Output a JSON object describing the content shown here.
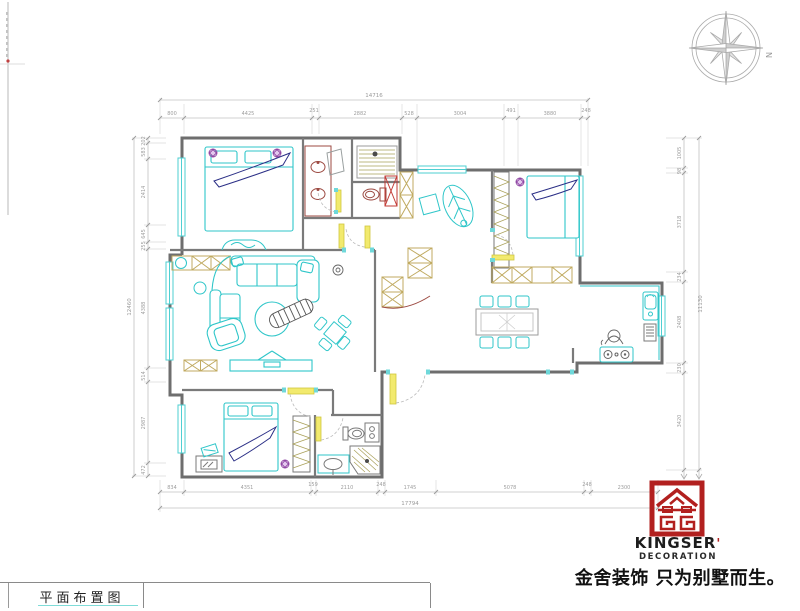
{
  "title_block": {
    "label": "平面布置图"
  },
  "compass": {
    "north_label": "N"
  },
  "logo": {
    "brand": "KINGSER",
    "apostrophe": "'",
    "subtitle": "DECORATION",
    "slogan": "金舍装饰 只为别墅而生。",
    "color": "#b2201f"
  },
  "dimensions": {
    "top": {
      "total": "14716",
      "segments": [
        "800",
        "4425",
        "251",
        "2882",
        "528",
        "3004",
        "491",
        "3880",
        "248"
      ]
    },
    "bottom": {
      "total": "17794",
      "segments": [
        "834",
        "4351",
        "159",
        "2110",
        "248",
        "1745",
        "5078",
        "248",
        "2300"
      ]
    },
    "left": {
      "total": "12460",
      "segments": [
        "202",
        "583",
        "2414",
        "645",
        "255",
        "4388",
        "514",
        "2987",
        "472"
      ]
    },
    "right": {
      "total": "11130",
      "segments": [
        "1005",
        "98",
        "3718",
        "234",
        "2408",
        "230",
        "3420"
      ]
    }
  },
  "colors": {
    "furniture_cyan": "#2fc6c9",
    "wall_gray": "#6e6e6e",
    "bath_maroon": "#9c4a42",
    "door_yellow": "#f2ea6e",
    "marker_purple": "#8b3fa0",
    "bed_navy": "#2b2f86",
    "logo_red": "#b2201f"
  }
}
